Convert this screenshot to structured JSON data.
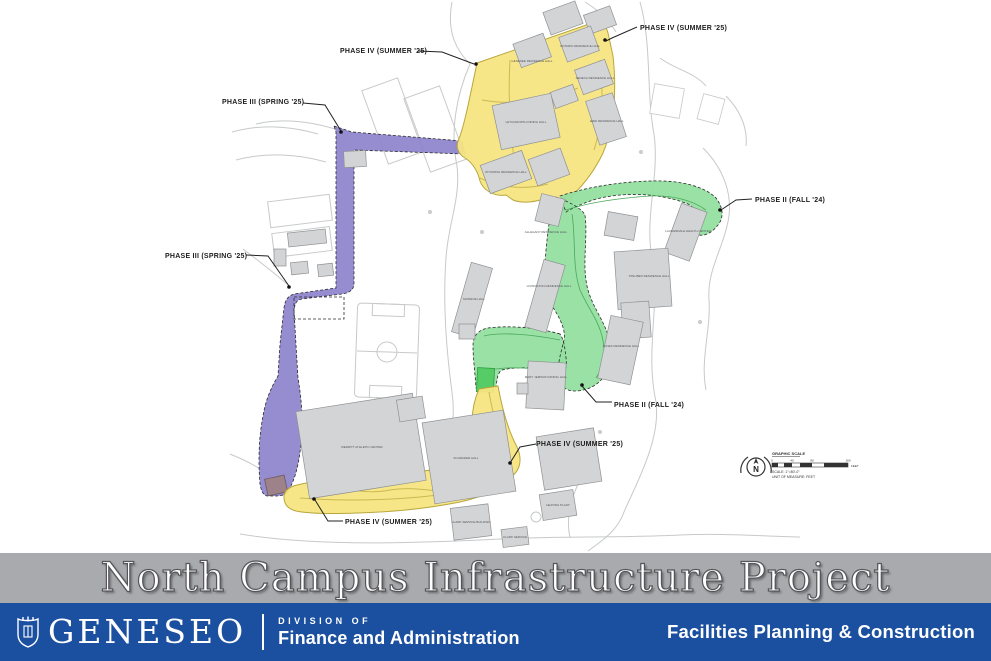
{
  "map": {
    "phase_labels": [
      {
        "text": "PHASE IV (SUMMER '25)"
      },
      {
        "text": "PHASE IV (SUMMER '25)"
      },
      {
        "text": "PHASE III (SPRING '25)"
      },
      {
        "text": "PHASE III (SPRING '25)"
      },
      {
        "text": "PHASE II (FALL '24)"
      },
      {
        "text": "PHASE II (FALL '24)"
      },
      {
        "text": "PHASE IV (SUMMER '25)"
      },
      {
        "text": "PHASE IV (SUMMER '25)"
      }
    ],
    "buildings": [
      {
        "label": "ONTARIO RESIDENCE HALL"
      },
      {
        "label": "GENESEE RESIDENCE HALL"
      },
      {
        "label": "SENECA RESIDENCE HALL"
      },
      {
        "label": "LETCHWORTH DINING HALL"
      },
      {
        "label": "ERIE RESIDENCE HALL"
      },
      {
        "label": "WYOMING RESIDENCE HALL"
      },
      {
        "label": "ALLEGANY RESIDENCE HALL"
      },
      {
        "label": "LAUDERDALE HEALTH CENTER"
      },
      {
        "label": "STEUBEN RESIDENCE HALL"
      },
      {
        "label": "MONROE HALL"
      },
      {
        "label": "LIVINGSTON RESIDENCE HALL"
      },
      {
        "label": "JONES RESIDENCE HALL"
      },
      {
        "label": "MARY JEMISON DINING HALL"
      },
      {
        "label": "MERRITT ATHLETIC CENTER"
      },
      {
        "label": "SCHRADER HALL"
      },
      {
        "label": "HEATING PLANT"
      },
      {
        "label": "CLARK SERVICE BUILDING"
      },
      {
        "label": "CLARK SERVICE"
      }
    ],
    "north_letter": "N",
    "scale": {
      "heading": "GRAPHIC SCALE",
      "ticks": [
        "0",
        "40",
        "80",
        "160"
      ],
      "feet_label": "FEET",
      "scale_note": "SCALE: 1\"=80'-0\"",
      "unit_note": "UNIT OF MEASURE: FEET"
    },
    "colors": {
      "phase2_green": "#93dfa0",
      "phase3_purple": "#8d83cd",
      "phase4_yellow": "#f5e582",
      "building_gray": "#d3d4d6",
      "road_gray": "#c7c9ca"
    }
  },
  "banner": {
    "title": "North Campus Infrastructure Project",
    "background": "#a8aaad"
  },
  "footer": {
    "wordmark": "GENESEO",
    "division_label": "DIVISION OF",
    "division_name": "Finance and Administration",
    "department": "Facilities Planning & Construction",
    "background": "#1b4f9f"
  }
}
